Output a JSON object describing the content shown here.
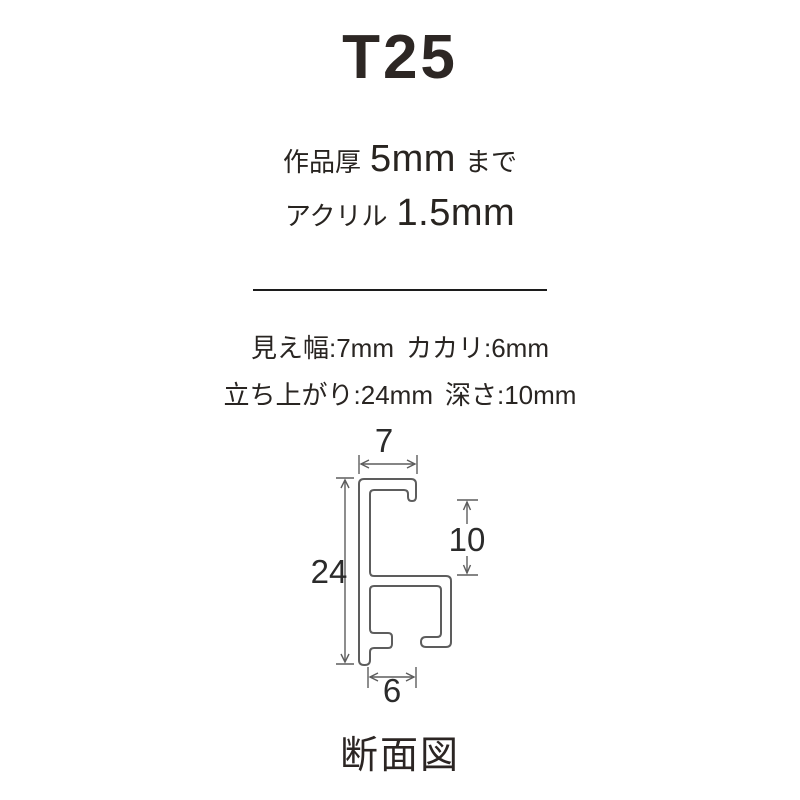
{
  "header": {
    "title": "T25",
    "spec_work": {
      "label": "作品厚",
      "value": "5mm",
      "suffix": "まで"
    },
    "spec_acrylic": {
      "label": "アクリル",
      "value": "1.5mm"
    }
  },
  "details": {
    "visible_width": "見え幅:7mm",
    "kakari": "カカリ:6mm",
    "rise": "立ち上がり:24mm",
    "depth": "深さ:10mm"
  },
  "diagram": {
    "caption": "断面図",
    "dim_top_width_mm": "7",
    "dim_height_mm": "24",
    "dim_inner_depth_mm": "10",
    "dim_bottom_width_mm": "6"
  },
  "colors": {
    "text": "#2c2622",
    "diagram_line": "#5d5d5d",
    "divider": "#1c1c1c",
    "background": "#ffffff"
  }
}
